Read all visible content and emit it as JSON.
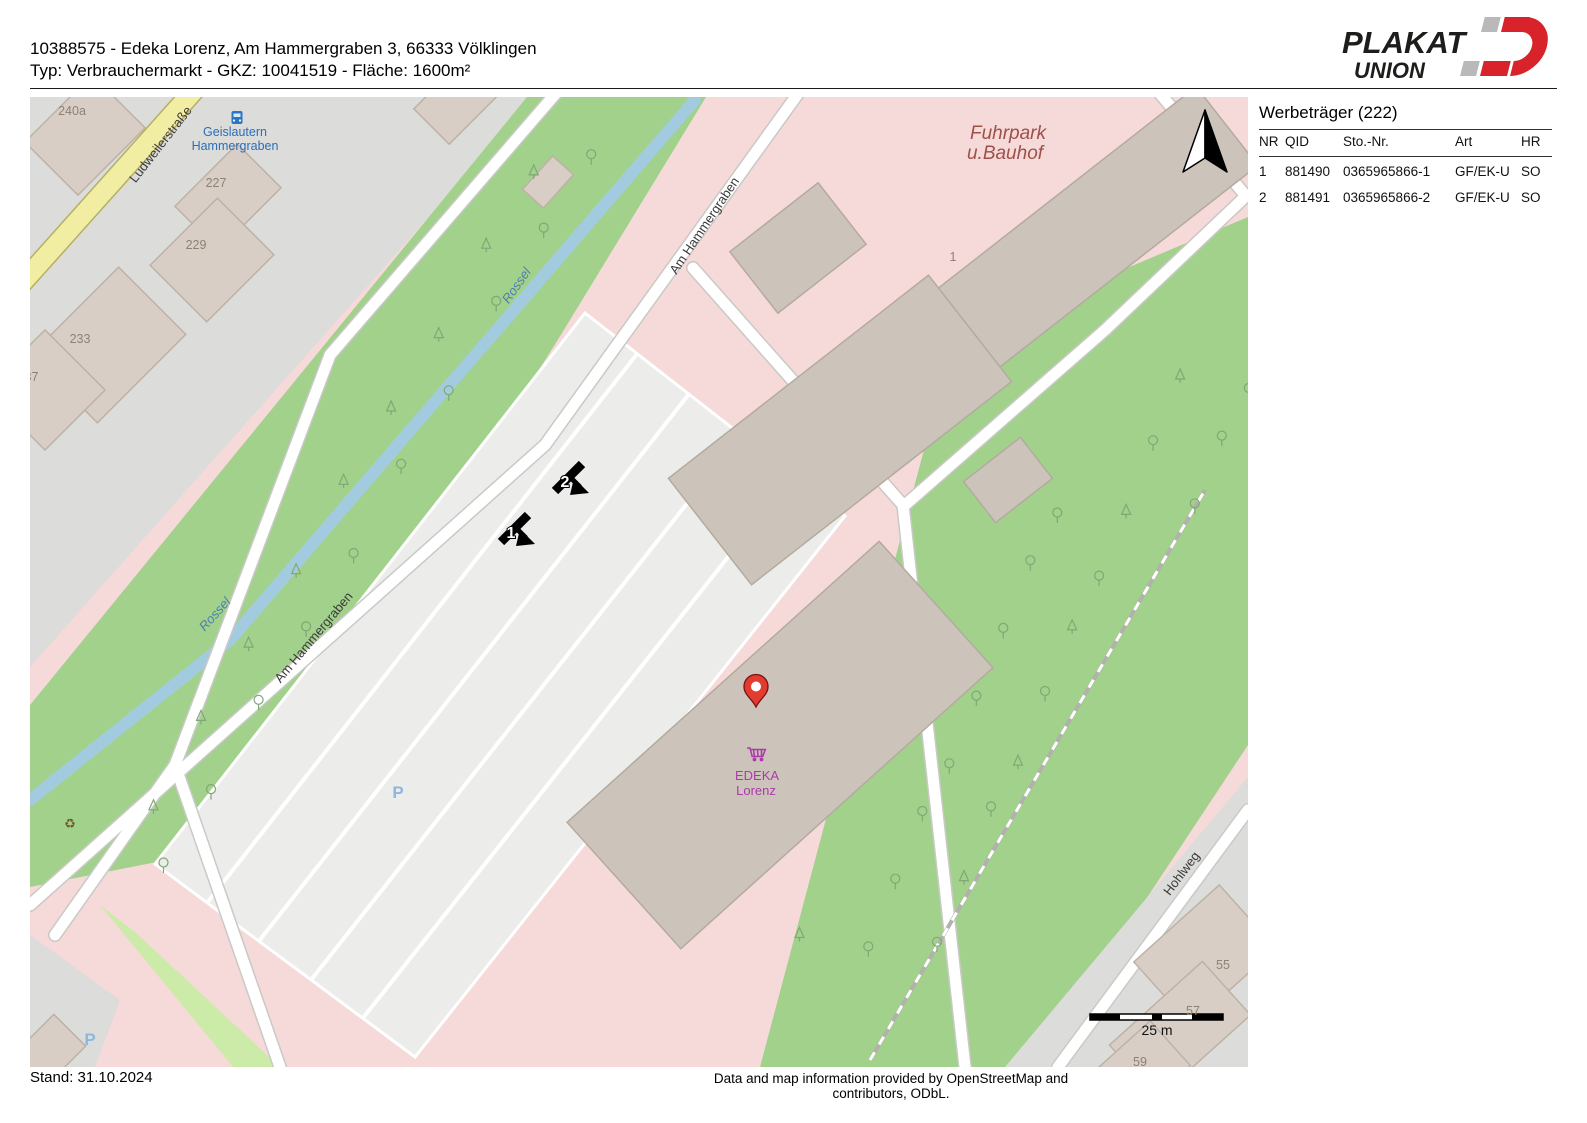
{
  "header": {
    "line1": "10388575 - Edeka Lorenz, Am Hammergraben 3, 66333 Völklingen",
    "line2": "Typ: Verbrauchermarkt - GKZ: 10041519 - Fläche: 1600m²"
  },
  "logo": {
    "line1": "PLAKAT",
    "line2": "UNION",
    "accent": "#d8232a",
    "gray": "#b9b9b9"
  },
  "panel": {
    "title": "Werbeträger (222)",
    "columns": [
      "NR",
      "QID",
      "Sto.-Nr.",
      "Art",
      "HR"
    ],
    "rows": [
      [
        "1",
        "881490",
        "0365965866-1",
        "GF/EK-U",
        "SO"
      ],
      [
        "2",
        "881491",
        "0365965866-2",
        "GF/EK-U",
        "SO"
      ]
    ]
  },
  "footer": {
    "stand": "Stand: 31.10.2024",
    "attribution": "Data and map information provided by OpenStreetMap and contributors, ODbL."
  },
  "map": {
    "scale_label": "25 m",
    "pin": {
      "x": 726,
      "y": 610
    },
    "billboards": [
      {
        "number": "1",
        "x": 486,
        "y": 431
      },
      {
        "number": "2",
        "x": 540,
        "y": 380
      }
    ],
    "labels": [
      {
        "name": "street-ludweilerstrasse",
        "text": "Ludweilerstraße",
        "x": 134,
        "y": 50,
        "rot": -52,
        "cls": "lbl-street"
      },
      {
        "name": "street-am-hammergraben-1",
        "text": "Am Hammergraben",
        "x": 678,
        "y": 131,
        "rot": -56,
        "cls": "lbl-street"
      },
      {
        "name": "street-am-hammergraben-2",
        "text": "Am Hammergraben",
        "x": 287,
        "y": 543,
        "rot": -50,
        "cls": "lbl-street"
      },
      {
        "name": "street-hohlweg",
        "text": "Hohlweg",
        "x": 1155,
        "y": 779,
        "rot": -53,
        "cls": "lbl-street"
      },
      {
        "name": "water-rossel-1",
        "text": "Rossel",
        "x": 490,
        "y": 191,
        "rot": -55,
        "cls": "lbl-water"
      },
      {
        "name": "water-rossel-2",
        "text": "Rossel",
        "x": 188,
        "y": 520,
        "rot": -48,
        "cls": "lbl-water"
      },
      {
        "name": "place-fuhrpark-line1",
        "text": "Fuhrpark",
        "x": 978,
        "y": 42,
        "rot": 0,
        "cls": "lbl-place"
      },
      {
        "name": "place-fuhrpark-line2",
        "text": "u.Bauhof",
        "x": 975,
        "y": 62,
        "rot": 0,
        "cls": "lbl-place"
      },
      {
        "name": "busstop-geislautern-line1",
        "text": "Geislautern",
        "x": 205,
        "y": 39,
        "rot": 0,
        "cls": "lbl-bus"
      },
      {
        "name": "busstop-geislautern-line2",
        "text": "Hammergraben",
        "x": 205,
        "y": 53,
        "rot": 0,
        "cls": "lbl-bus"
      },
      {
        "name": "shop-edeka-line1",
        "text": "EDEKA",
        "x": 727,
        "y": 683,
        "rot": 0,
        "cls": "lbl-shop"
      },
      {
        "name": "shop-edeka-line2",
        "text": "Lorenz",
        "x": 726,
        "y": 698,
        "rot": 0,
        "cls": "lbl-shop"
      },
      {
        "name": "parking-p-1",
        "text": "P",
        "x": 368,
        "y": 701,
        "rot": 0,
        "cls": "lbl-p"
      },
      {
        "name": "parking-p-2",
        "text": "P",
        "x": 60,
        "y": 948,
        "rot": 0,
        "cls": "lbl-p"
      },
      {
        "name": "recycling",
        "text": "♻",
        "x": 40,
        "y": 731,
        "rot": 0,
        "cls": "lbl-recycle"
      }
    ],
    "house_numbers": [
      {
        "text": "240a",
        "x": 42,
        "y": 18
      },
      {
        "text": "227",
        "x": 186,
        "y": 90
      },
      {
        "text": "229",
        "x": 166,
        "y": 152
      },
      {
        "text": "233",
        "x": 50,
        "y": 246
      },
      {
        "text": "237",
        "x": -2,
        "y": 284
      },
      {
        "text": "1",
        "x": 923,
        "y": 164
      },
      {
        "text": "55",
        "x": 1193,
        "y": 872
      },
      {
        "text": "57",
        "x": 1163,
        "y": 918
      },
      {
        "text": "59",
        "x": 1110,
        "y": 969
      }
    ],
    "colors": {
      "land": "#dcdcda",
      "retail": "#f6d9d9",
      "forest": "#a2d18c",
      "grass": "#cdeba8",
      "water": "#a3cbdf",
      "parking": "#ececea",
      "road_casing": "#c9c9c6",
      "yellow_road": "#f1eda2",
      "yellow_casing": "#b5b061",
      "building": "#d8cec6",
      "building_stroke": "#bcb2a6",
      "building2": "#ccc4ba",
      "building2_stroke": "#b3ab9f",
      "tree": "#7fa874",
      "water_label": "#4d7fae",
      "place_label": "#9e5149",
      "bus_label": "#2b6fb8",
      "shop_label": "#ac39ac",
      "house_label": "#8f8173",
      "parking_label": "#8cb8dd",
      "pin": "#e23b30"
    }
  }
}
